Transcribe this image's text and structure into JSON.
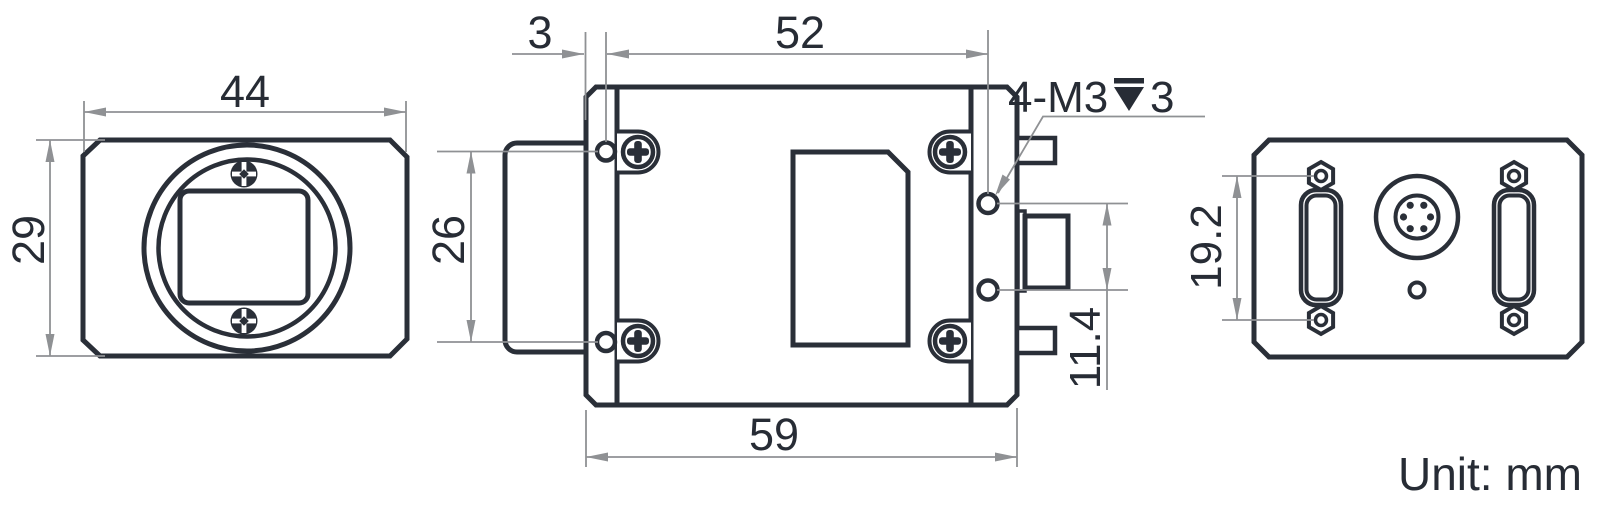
{
  "drawing": {
    "title": "camera-dimension-drawing",
    "unit_note": "Unit: mm",
    "front_view": {
      "width_mm": "44",
      "height_mm": "29"
    },
    "top_view": {
      "flange_offset_mm": "3",
      "body_length_mm": "52",
      "overall_length_mm": "59",
      "lens_mount_width_mm": "26",
      "hole_pitch_mm": "11.4",
      "thread_callout_prefix": "4-M3",
      "thread_callout_depth": "3"
    },
    "rear_view": {
      "screw_spacing_mm": "19.2"
    },
    "colors": {
      "line_dark": "#2a2f38",
      "dim_gray": "#8f9194"
    }
  }
}
